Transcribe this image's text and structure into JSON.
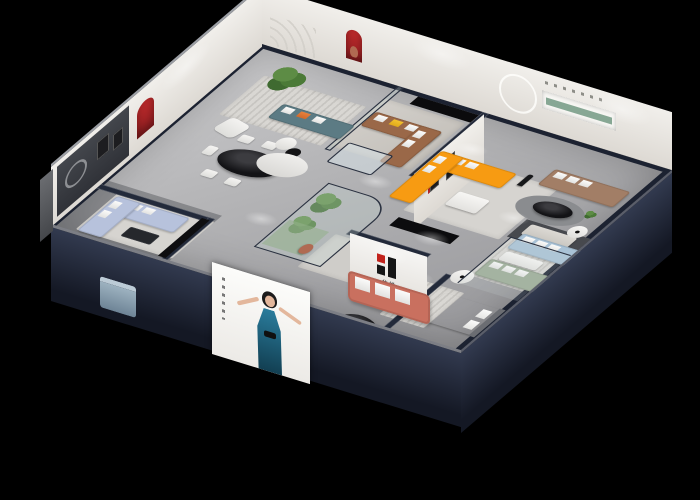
{
  "scene": {
    "description": "Isometric cutaway 3D render of a furniture showroom apartment on a black background",
    "background": "#000000",
    "brand": {
      "logo_text": "华悦",
      "logo_red": "#c2231c",
      "logo_black": "#151515"
    },
    "palette": {
      "wall_edge_navy": "#1e2433",
      "exterior_wall": "#2b3245",
      "floor": "#b3b3b5",
      "rug": "#d4d2ce",
      "accent_arch_red": "#b3262a",
      "niche_green": "#8fae9c",
      "sofa_periwinkle": "#b7c2dc",
      "sofa_teal": "#5c7b84",
      "sofa_caramel": "#9a6848",
      "sofa_orange": "#f79b12",
      "sofa_tan": "#a27e66",
      "sofa_coral": "#c96f5e",
      "sofa_powder_blue": "#a9c2d6",
      "sofa_sage": "#9cab95",
      "poster_dress_teal": "#1a5f7d"
    },
    "rooms": [
      {
        "name": "dining-room",
        "items": [
          "black-oval-dining-table",
          "white-chairs",
          "red-arch-niche",
          "dark-accent-wall"
        ]
      },
      {
        "name": "west-living-room",
        "items": [
          "periwinkle-sofa-set",
          "black-media-console",
          "coffee-table"
        ]
      },
      {
        "name": "north-lounge",
        "items": [
          "teal-sofa",
          "white-armchair",
          "potted-tree",
          "round-coffee-tables"
        ]
      },
      {
        "name": "caramel-lounge",
        "items": [
          "caramel-l-sofa",
          "glass-display-table",
          "red-arch-niche-with-bear"
        ]
      },
      {
        "name": "orange-lounge",
        "items": [
          "orange-l-sofa",
          "white-coffee-table",
          "figure-sculpture",
          "ring-light"
        ]
      },
      {
        "name": "east-living-room",
        "items": [
          "tan-sofa",
          "black-oval-table",
          "green-wall-niche"
        ]
      },
      {
        "name": "glass-atrium",
        "items": [
          "glass-partition",
          "green-plants",
          "bear-statue"
        ]
      },
      {
        "name": "logo-lounge",
        "items": [
          "brand-logo-wall",
          "coral-sofa",
          "black-oval-coffee-table",
          "white-ottoman"
        ]
      },
      {
        "name": "right-sofa-gallery",
        "items": [
          "powder-blue-sofa",
          "sage-green-sofa",
          "round-side-tables",
          "glass-corner"
        ]
      },
      {
        "name": "front-bedroom",
        "items": [
          "white-bed",
          "striped-rug",
          "small-desk"
        ]
      },
      {
        "name": "front-cut-wall",
        "items": [
          "woman-poster",
          "blue-ottoman-cube"
        ]
      }
    ]
  }
}
